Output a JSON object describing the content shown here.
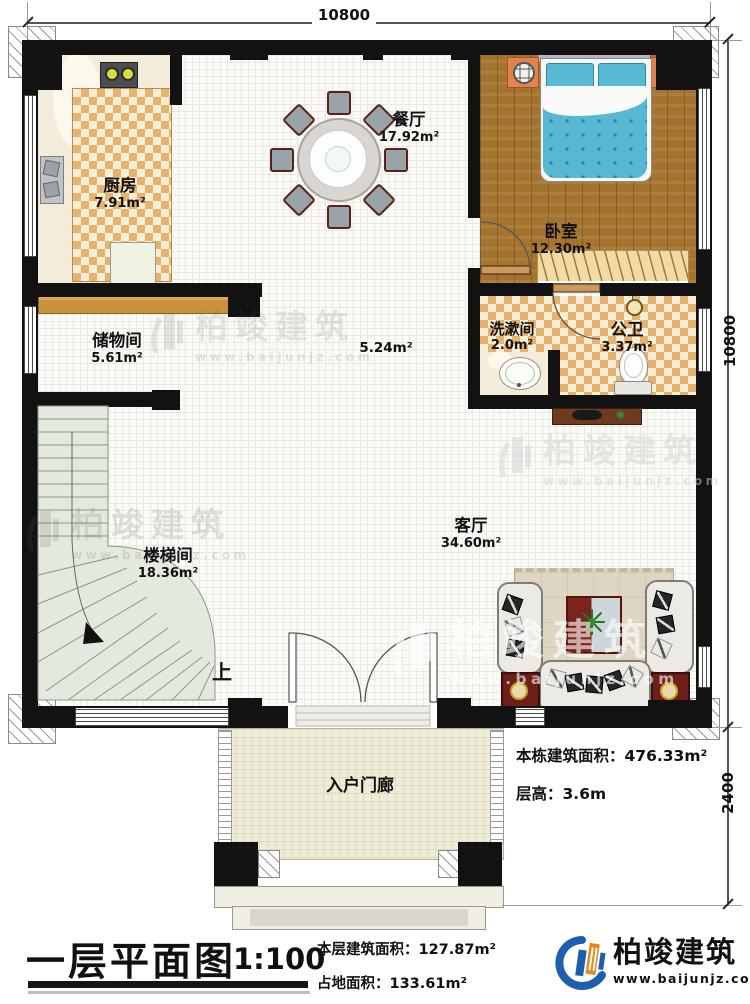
{
  "dimensions": {
    "top": "10800",
    "right_main": "10800",
    "right_porch": "2400"
  },
  "rooms": {
    "kitchen": {
      "name": "厨房",
      "area": "7.91m²"
    },
    "dining": {
      "name": "餐厅",
      "area": "17.92m²"
    },
    "bedroom": {
      "name": "卧室",
      "area": "12.30m²"
    },
    "washroom": {
      "name": "洗漱间",
      "area": "2.0m²"
    },
    "bathroom": {
      "name": "公卫",
      "area": "3.37m²"
    },
    "storage": {
      "name": "储物间",
      "area": "5.61m²"
    },
    "hallway": {
      "area": "5.24m²"
    },
    "stairwell": {
      "name": "楼梯间",
      "area": "18.36m²"
    },
    "living": {
      "name": "客厅",
      "area": "34.60m²"
    },
    "porch": {
      "name": "入户门廊"
    },
    "stair_up": "上"
  },
  "stats": {
    "building_total_label": "本栋建筑面积：",
    "building_total_value": "476.33m²",
    "floor_height_label": "层高：",
    "floor_height_value": "3.6m"
  },
  "titleblock": {
    "title": "一层平面图",
    "scale": "1:100",
    "floor_area_label": "本层建筑面积：",
    "floor_area_value": "127.87m²",
    "land_area_label": "占地面积：",
    "land_area_value": "133.61m²"
  },
  "branding": {
    "name": "柏竣建筑",
    "url": "www.baijunjz.com",
    "blue": "#1d5fae",
    "orange": "#e8861c"
  },
  "watermark": {
    "name": "柏竣建筑",
    "url": "www.baijunjz.com"
  },
  "colors": {
    "wall": "#121212",
    "checker": "#e7b26e",
    "wood": "#a4742f",
    "bedding": "#57b8d4",
    "stairs": "#e4e9df"
  }
}
